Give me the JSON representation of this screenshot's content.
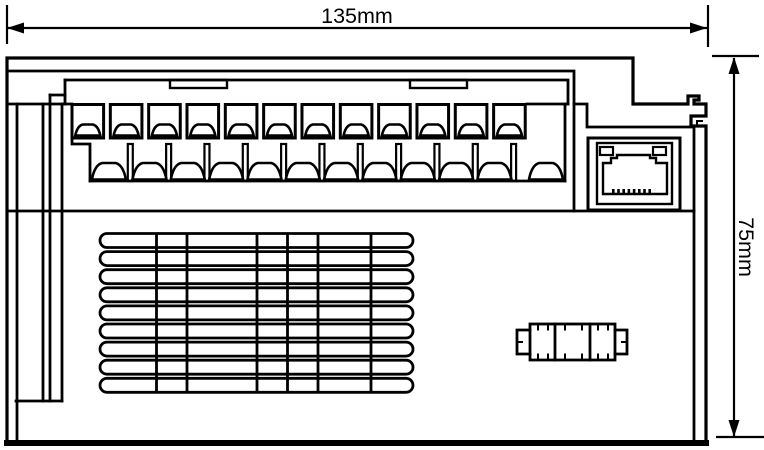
{
  "page": {
    "background_color": "#ffffff",
    "line_color": "#000000"
  },
  "drawing": {
    "type": "technical dimension drawing, front elevation of a DIN-rail electronic module",
    "dimensions": {
      "width": {
        "label": "135mm"
      },
      "height": {
        "label": "75mm"
      }
    },
    "features": {
      "terminal_row_top": {
        "count": 12
      },
      "terminal_row_bottom": {
        "count": 12
      },
      "vent_grille": {
        "slot_rows": 9,
        "divider_count": 6
      },
      "ethernet_port": {
        "pin_count": 8
      },
      "expansion_connector": {
        "sections": 3
      }
    }
  }
}
